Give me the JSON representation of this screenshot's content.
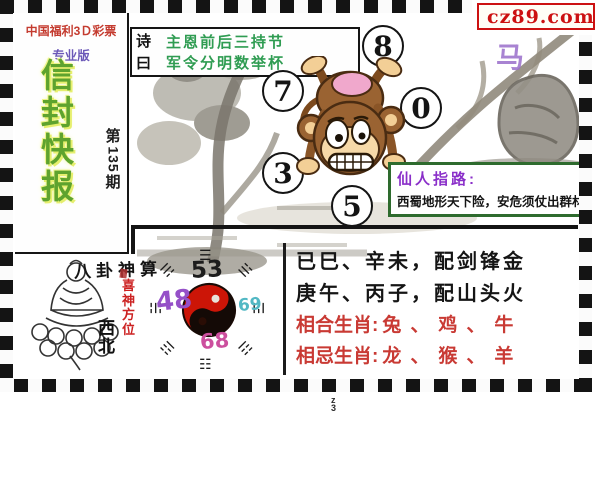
{
  "logo": {
    "text": "cz89.com",
    "icon": "yellow-square-icon"
  },
  "sidebar": {
    "org": "中国福利3Ｄ彩票",
    "edition": "专业版",
    "title": "信封快报",
    "issue_prefix": "第",
    "issue_number": "135",
    "issue_suffix": "期"
  },
  "poem": {
    "label": "诗曰",
    "line1": "主恩前后三持节",
    "line2": "军令分明数举杯"
  },
  "circles": {
    "numbers": [
      "8",
      "7",
      "0",
      "3",
      "5"
    ]
  },
  "pointer": {
    "title": "仙人指路:",
    "text": "西蜀地形天下险，安危须仗出群材"
  },
  "watermark": "马",
  "panel": {
    "calligraphy": "八卦神算",
    "luck_label": "喜神方位",
    "luck_direction": "西北",
    "bagua": {
      "top": "53",
      "left": "48",
      "right": "69",
      "bottom": "68",
      "trigrams": [
        "☰",
        "☱",
        "☲",
        "☳",
        "☷",
        "☶",
        "☵",
        "☴"
      ]
    },
    "line1": "已巳、辛未，配剑锋金",
    "line2": "庚午、丙子，配山头火",
    "compat_label": "相合生肖:",
    "compat_values": "兔、鸡、牛",
    "incompat_label": "相忌生肖:",
    "incompat_values": "龙、猴、羊"
  },
  "footer_mark": "z3",
  "colors": {
    "logo_red": "#cc1111",
    "title_green": "#5ea32e",
    "poem_green": "#2f9c52",
    "pointer_purple": "#8a2fc9",
    "pointer_border_green": "#2e6b2e",
    "zodiac_red": "#c93a34",
    "bagua_left_purple": "#9550c8",
    "bagua_right_cyan": "#52b8c4",
    "bagua_bottom_magenta": "#cc4f9e"
  }
}
